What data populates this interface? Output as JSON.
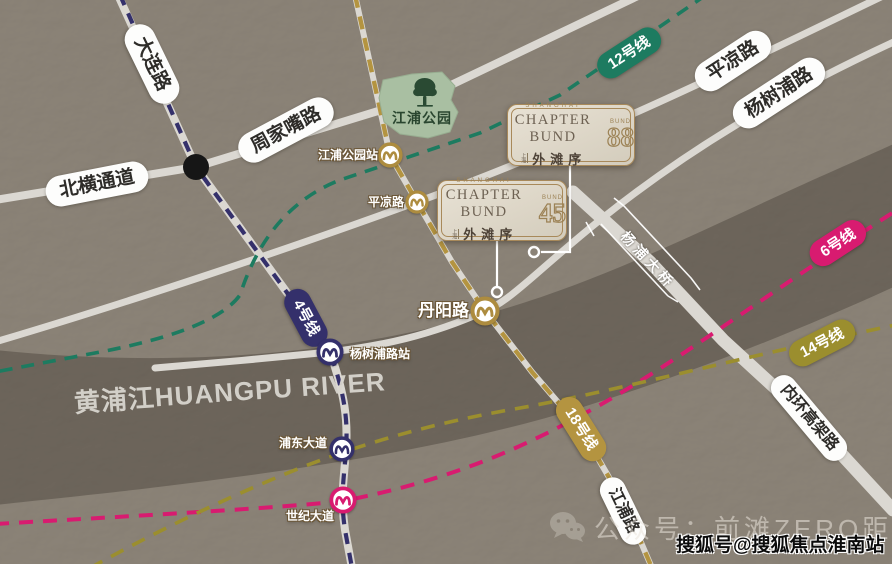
{
  "page": {
    "width": 892,
    "height": 564,
    "kind": "real-estate location map"
  },
  "colors": {
    "land": "#8b8377",
    "river": "#6d655b",
    "road": "#dbd8d2",
    "line4": "#34306b",
    "line6": "#d81b70",
    "line12": "#1d7b60",
    "line14": "#9b8e2e",
    "line18": "#b49440",
    "park_fill": "#a9bfa2",
    "park_text": "#29452f",
    "card_bg": "#ddd6c7",
    "card_border": "#a8895a",
    "card_gold": "#9c8255"
  },
  "river": {
    "label": "黄浦江HUANGPU RIVER"
  },
  "park": {
    "label": "江浦公园"
  },
  "roads": {
    "dalian": "大连路",
    "zhoujiazui": "周家嘴路",
    "beiheng": "北横通道",
    "pingliang": "平凉路",
    "yangshupu": "杨树浦路",
    "jiangpu": "江浦路",
    "neihuan": "内环高架路",
    "bridge": "杨浦大桥"
  },
  "metro_lines": {
    "l12": {
      "label": "12号线",
      "color": "#1d7b60"
    },
    "l4": {
      "label": "4号线",
      "color": "#34306b"
    },
    "l6": {
      "label": "6号线",
      "color": "#d81b70"
    },
    "l14": {
      "label": "14号线",
      "color": "#9b8e2e"
    },
    "l18": {
      "label": "18号线",
      "color": "#b49440"
    }
  },
  "stations": {
    "jiangpu_park": "江浦公园站",
    "pingliang": "平凉路",
    "danyang": "丹阳路",
    "yangshupu": "杨树浦路站",
    "pudong_ave": "浦东大道",
    "century_ave": "世纪大道"
  },
  "cards": [
    {
      "region": "SHANGHAI",
      "title": "CHAPTER BUND",
      "mark": "上海",
      "cn_name": "外滩序",
      "bund_word": "BUND",
      "bund_num": "88"
    },
    {
      "region": "SHANGHAI",
      "title": "CHAPTER BUND",
      "mark": "上海",
      "cn_name": "外滩序",
      "bund_word": "BUND",
      "bund_num": "45"
    }
  ],
  "watermarks": {
    "wechat": "公众号：前滩ZERO距离",
    "sohu": "搜狐号@搜狐焦点淮南站"
  }
}
